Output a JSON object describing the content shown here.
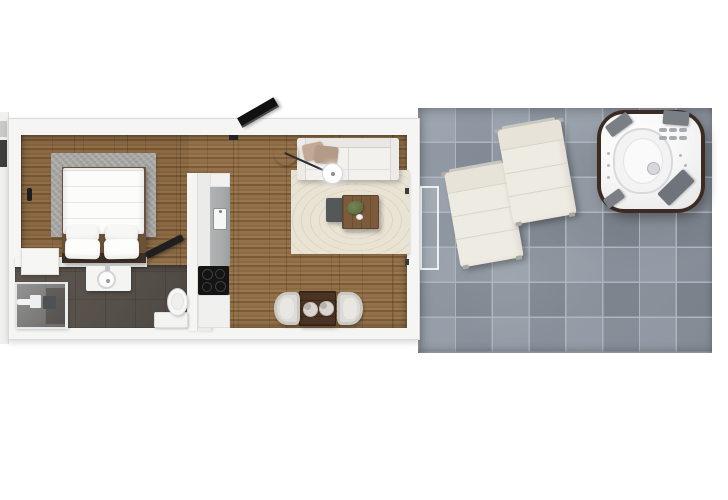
{
  "scene": {
    "title": "Studio apartment with terrace - 3D floor plan, top-down render",
    "has_text": false,
    "apartment": {
      "rooms": [
        {
          "name": "bedroom",
          "floor": "wood-plank",
          "items": [
            "double-bed",
            "duvet",
            "pillows-x4",
            "gray-area-rug",
            "nightstand",
            "entry-door-handle",
            "luggage-rack",
            "wall-tv"
          ]
        },
        {
          "name": "bathroom",
          "floor": "dark-tile",
          "items": [
            "walk-in-shower",
            "vanity-with-round-basin",
            "toilet"
          ]
        },
        {
          "name": "kitchen",
          "floor": "wood-plank",
          "items": [
            "tall-cabinet-run",
            "gray-countertop",
            "kitchen-sink",
            "cooktop-4-burners",
            "base-cabinet"
          ]
        },
        {
          "name": "living-room",
          "floor": "wood-plank",
          "items": [
            "white-sofa",
            "throw-pillows-x2",
            "floor-lamp",
            "beige-area-rug",
            "wood-coffee-table",
            "potted-plant",
            "dark-side-table"
          ]
        },
        {
          "name": "dining-area",
          "floor": "wood-plank",
          "items": [
            "dark-wood-table",
            "dinner-plates-x2",
            "tub-chair-left",
            "tub-chair-right"
          ]
        }
      ],
      "openings": [
        "left-wall-window",
        "bathroom-doorway",
        "sliding-glass-door-to-terrace"
      ]
    },
    "terrace": {
      "floor": "concrete-tile",
      "tile_grid": {
        "columns": 8,
        "rows": 7
      },
      "items": [
        "sun-lounger-left",
        "sun-lounger-right",
        "hot-tub-with-headrest-pads",
        "door-threshold"
      ]
    }
  },
  "colors": {
    "wall": "#f5f5f4",
    "wall_edge": "#d9d9d7",
    "wood_light": "#9a774e",
    "wood_mid": "#8c6b44",
    "wood_dark": "#7c5c38",
    "bath_floor": "#56504a",
    "tile": "#8c95a0",
    "grout": "#aeb5bd",
    "rug_bed": "#a5a4a1",
    "rug_living": "#e9e3d4",
    "sofa": "#f2f1ee",
    "pillow1": "#c3a995",
    "pillow2": "#b49b87",
    "lamp_base": "#5d6266",
    "coffee": "#7b5b3c",
    "side_table": "#54585b",
    "din_table": "#4a3322",
    "chair": "#dcdbd6",
    "counter": "#a7abab",
    "cabinet": "#ebebe9",
    "cooktop": "#141414",
    "fixture": "#f4f4f3",
    "tub_rim": "#3b2b23",
    "pad": "#7a7f86",
    "lounger": "#eeebe2",
    "plant": "#5f7040",
    "accent_dark": "#1d1d1d"
  }
}
